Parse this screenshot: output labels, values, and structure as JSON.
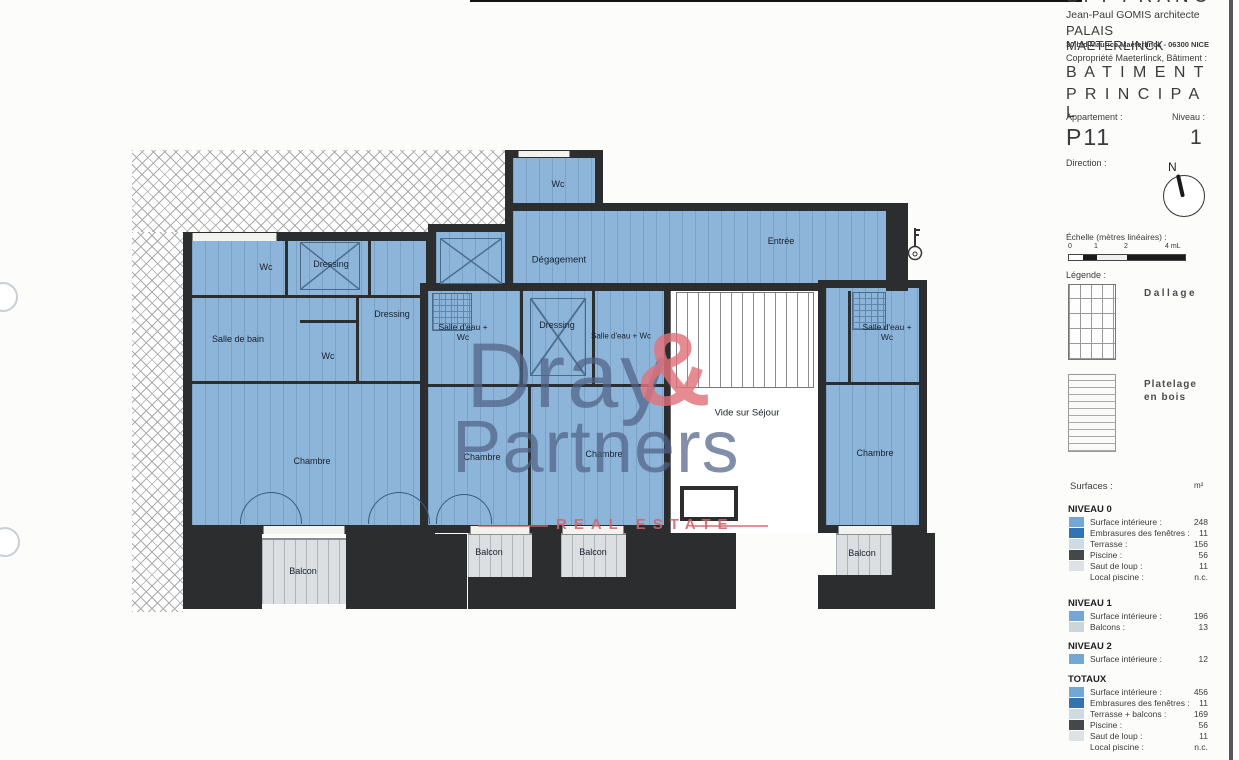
{
  "header": {
    "company_top": "SPI FRANCE",
    "architect": "Jean-Paul GOMIS architecte",
    "building": "PALAIS MAETERLINCK",
    "address": "30 bld Maurice Maeterlinck - 06300 NICE",
    "copropriete": "Copropriété Maeterlinck, Bâtiment :",
    "batiment": "B A T I M E N T",
    "principal": "P R I N C I P A L"
  },
  "apartment": {
    "appartement_label": "Appartement :",
    "appartement_value": "P11",
    "niveau_label": "Niveau :",
    "niveau_value": "1",
    "direction_label": "Direction :",
    "north": "N"
  },
  "scale": {
    "label": "Échelle (mètres linéaires) :",
    "ticks": [
      "0",
      "1",
      "2",
      "4 mL"
    ]
  },
  "legend": {
    "label": "Légende :",
    "items": [
      {
        "label": "Dallage"
      },
      {
        "label": "Platelage en bois"
      }
    ]
  },
  "surfaces": {
    "label": "Surfaces :",
    "unit": "m²",
    "sections": [
      {
        "title": "NIVEAU 0",
        "rows": [
          {
            "label": "Surface intérieure :",
            "value": "248",
            "swatch": "#72a7d6"
          },
          {
            "label": "Embrasures des fenêtres :",
            "value": "11",
            "swatch": "#2f74b3"
          },
          {
            "label": "Terrasse :",
            "value": "156",
            "swatch": "#cfdae2"
          },
          {
            "label": "Piscine :",
            "value": "56",
            "swatch": "#45484a"
          },
          {
            "label": "Saut de loup :",
            "value": "11",
            "swatch": "#dde2e6"
          },
          {
            "label": "Local piscine :",
            "value": "n.c.",
            "swatch": ""
          }
        ]
      },
      {
        "title": "NIVEAU 1",
        "rows": [
          {
            "label": "Surface intérieure :",
            "value": "196",
            "swatch": "#72a7d6"
          },
          {
            "label": "Balcons :",
            "value": "13",
            "swatch": "#cdd5da"
          }
        ]
      },
      {
        "title": "NIVEAU 2",
        "rows": [
          {
            "label": "Surface intérieure :",
            "value": "12",
            "swatch": "#72a7d6"
          }
        ]
      },
      {
        "title": "TOTAUX",
        "rows": [
          {
            "label": "Surface intérieure :",
            "value": "456",
            "swatch": "#72a7d6"
          },
          {
            "label": "Embrasures des fenêtres :",
            "value": "11",
            "swatch": "#2f74b3"
          },
          {
            "label": "Terrasse + balcons :",
            "value": "169",
            "swatch": "#cfdae2"
          },
          {
            "label": "Piscine :",
            "value": "56",
            "swatch": "#45484a"
          },
          {
            "label": "Saut de loup :",
            "value": "11",
            "swatch": "#dde2e6"
          },
          {
            "label": "Local piscine :",
            "value": "n.c.",
            "swatch": ""
          }
        ]
      }
    ]
  },
  "plan": {
    "rooms": [
      {
        "label": "Wc"
      },
      {
        "label": "Dégagement"
      },
      {
        "label": "Entrée"
      },
      {
        "label": "Wc"
      },
      {
        "label": "Dressing"
      },
      {
        "label": "Dressing"
      },
      {
        "label": "Salle de bain"
      },
      {
        "label": "Wc"
      },
      {
        "label": "Salle d'eau + Wc"
      },
      {
        "label": "Dressing"
      },
      {
        "label": "Salle d'eau + Wc"
      },
      {
        "label": "Salle d'eau + Wc"
      },
      {
        "label": "Vide sur Séjour"
      },
      {
        "label": "Chambre"
      },
      {
        "label": "Chambre"
      },
      {
        "label": "Chambre"
      },
      {
        "label": "Chambre"
      },
      {
        "label": "Balcon"
      },
      {
        "label": "Balcon"
      },
      {
        "label": "Balcon"
      },
      {
        "label": "Balcon"
      }
    ],
    "watermark": {
      "line1": "Dray",
      "amp": "&",
      "line2": "Partners",
      "tagline": "REAL ESTATE"
    }
  },
  "colors": {
    "room_fill": "#8cb5d9",
    "wall": "#2c2d2e",
    "watermark_blue": "#506385",
    "watermark_red": "#e2717a"
  }
}
